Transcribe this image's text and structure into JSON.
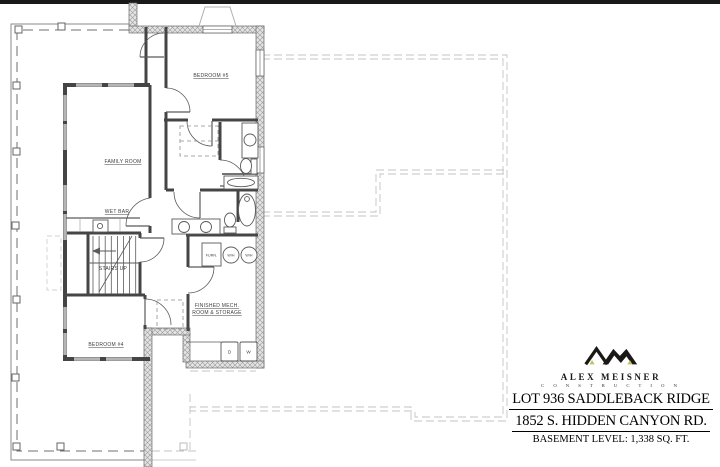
{
  "plan": {
    "rooms": {
      "bedroom5": "BEDROOM #5",
      "family_room": "FAMILY ROOM",
      "wet_bar": "WET BAR",
      "stairs": "STAIRS UP",
      "bedroom4": "BEDROOM #4",
      "mech_line1": "FINISHED MECH.",
      "mech_line2": "ROOM & STORAGE"
    },
    "equipment": {
      "furnace": "FURN.",
      "water_heater_1": "W/H",
      "water_heater_2": "W/H",
      "dryer": "D",
      "washer": "W"
    }
  },
  "title_block": {
    "company_name": "ALEX MEISNER",
    "company_sub": "C O N S T R U C T I O N",
    "line1": "LOT 936 SADDLEBACK RIDGE",
    "line2": "1852 S. HIDDEN CANYON RD.",
    "line3": "BASEMENT LEVEL:  1,338 SQ. FT.",
    "logo_colors": {
      "black": "#1b1916",
      "accent": "#c2bf5e"
    }
  }
}
